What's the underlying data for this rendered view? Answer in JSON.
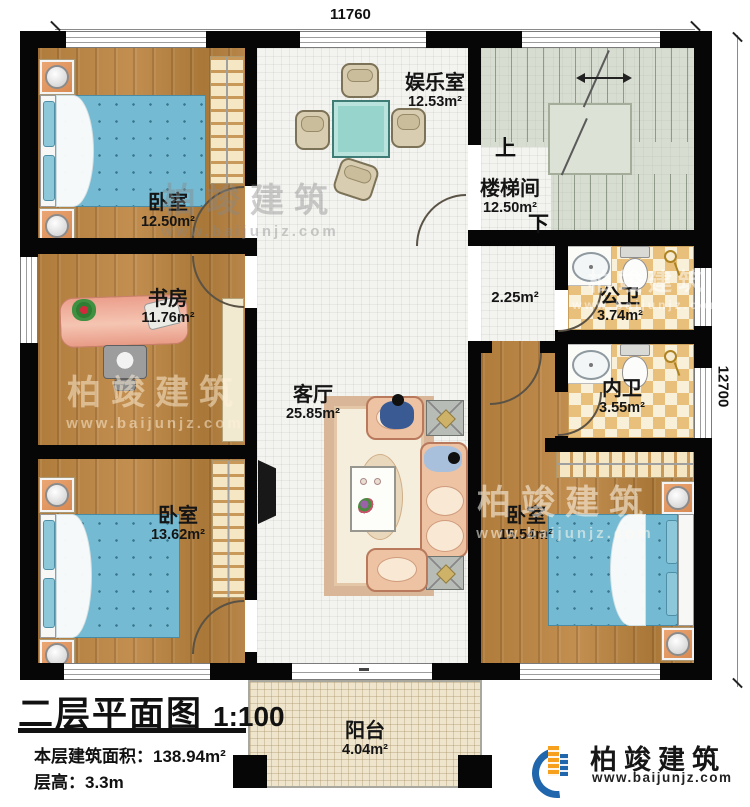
{
  "dimensions": {
    "width_mm": "11760",
    "height_mm": "12700"
  },
  "rooms": {
    "bedroom_top_left": {
      "name": "卧室",
      "area": "12.50m²"
    },
    "entertainment": {
      "name": "娱乐室",
      "area": "12.53m²"
    },
    "stairwell": {
      "name": "楼梯间",
      "area": "12.50m²",
      "up": "上",
      "down": "下"
    },
    "study": {
      "name": "书房",
      "area": "11.76m²"
    },
    "hallway": {
      "area": "2.25m²"
    },
    "public_bath": {
      "name": "公卫",
      "area": "3.74m²"
    },
    "private_bath": {
      "name": "内卫",
      "area": "3.55m²"
    },
    "living": {
      "name": "客厅",
      "area": "25.85m²"
    },
    "bedroom_bottom_left": {
      "name": "卧室",
      "area": "13.62m²"
    },
    "bedroom_bottom_right": {
      "name": "卧室",
      "area": "15.54m²"
    },
    "balcony": {
      "name": "阳台",
      "area": "4.04m²"
    }
  },
  "title_block": {
    "title": "二层平面图",
    "scale": "1:100",
    "area_label": "本层建筑面积：",
    "area_value": "138.94m²",
    "floor_height_label": "层高：",
    "floor_height_value": "3.3m"
  },
  "brand": {
    "name": "柏竣建筑",
    "website": "www.baijunjz.com"
  },
  "watermark": {
    "name": "柏竣建筑",
    "website": "www.baijunjz.com"
  },
  "colors": {
    "wall": "#060606",
    "wood_floor": "#b5813f",
    "tile_floor": "#f3f3f0",
    "stair_floor": "#d8ddd1",
    "bath_tile": "#e8bf7b",
    "balcony_floor": "#efe5cd",
    "bed_blue": "#74bad2",
    "nightstand_orange": "#e29a63",
    "brand_blue": "#1f66ad",
    "brand_orange": "#f6a01e"
  }
}
